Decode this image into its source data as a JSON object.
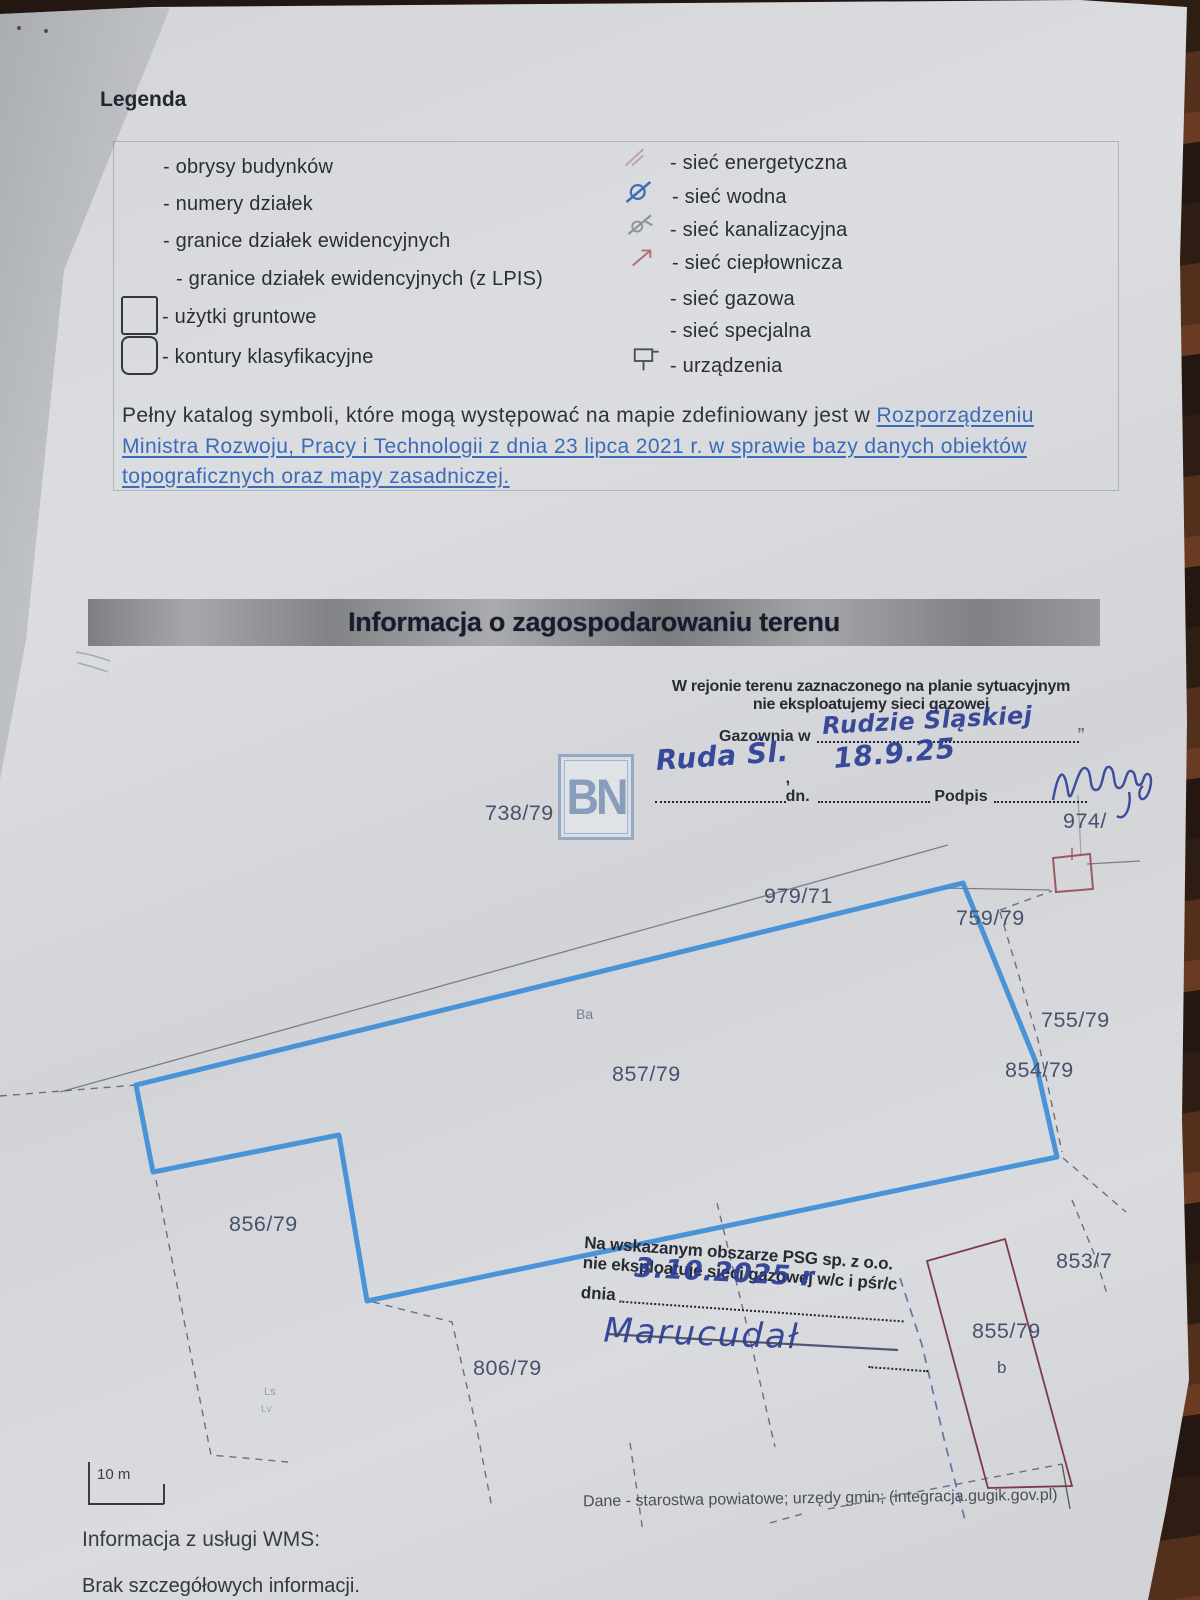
{
  "legend": {
    "title": "Legenda",
    "left_items": [
      "- obrysy budynków",
      "- numery działek",
      "- granice działek ewidencyjnych",
      "- granice działek ewidencyjnych (z LPIS)",
      "- użytki gruntowe",
      "- kontury klasyfikacyjne"
    ],
    "right_items": [
      "- sieć energetyczna",
      "- sieć wodna",
      "- sieć kanalizacyjna",
      "- sieć ciepłownicza",
      "- sieć gazowa",
      "- sieć specjalna",
      "- urządzenia"
    ],
    "catalog_note": {
      "plain": "Pełny katalog symboli, które mogą występować na mapie zdefiniowany jest w ",
      "link_line1": "Rozporządzeniu",
      "link_line2": "Ministra Rozwoju, Pracy i Technologii z dnia 23 lipca 2021 r. w sprawie bazy danych obiektów",
      "link_line3": "topograficznych oraz mapy zasadniczej."
    }
  },
  "section_title": "Informacja o zagospodarowaniu terenu",
  "gazownia_stamp": {
    "line1": "W rejonie terenu zaznaczonego na planie sytuacyjnym",
    "line2": "nie eksploatujemy sieci gazowej",
    "gazownia_label": "Gazownia w",
    "city_handwritten": "Rudzie Śląskiej",
    "place_handwritten": "Ruda Śl.",
    "dn_label": ", dn.",
    "date_handwritten": "18.9.25",
    "podpis_label": "Podpis"
  },
  "psg_stamp": {
    "line1": "Na wskazanym obszarze PSG sp. z o.o.",
    "line2": "nie eksploatuje sieci gazowej w/c i pśr/c",
    "dnia_label": "dnia",
    "date_handwritten": "3.10.2025 r",
    "signature_handwritten": "Marucudał"
  },
  "map": {
    "watermark": "BN",
    "parcel_labels": [
      {
        "text": "738/79"
      },
      {
        "text": "974/"
      },
      {
        "text": "979/71"
      },
      {
        "text": "759/79"
      },
      {
        "text": "755/79"
      },
      {
        "text": "854/79"
      },
      {
        "text": "857/79"
      },
      {
        "text": "856/79"
      },
      {
        "text": "853/7"
      },
      {
        "text": "855/79"
      },
      {
        "text": "806/79"
      }
    ],
    "land_use_label": "Ba",
    "building_letter": "b",
    "faint_code_1": "Ls",
    "faint_code_2": "Lv"
  },
  "scale_label": "10 m",
  "footer": {
    "source_line": "Dane - starostwa powiatowe; urzędy gmin; (integracja.gugik.gov.pl)",
    "wms_label": "Informacja z usługi WMS:",
    "wms_value": "Brak szczegółowych informacji."
  },
  "colors": {
    "highlight_boundary": "#3d8ed6",
    "link_blue": "#3a6cb8",
    "ink_blue": "#2c3d94",
    "building_outline_maroon": "#7d3b4a",
    "building_outline_red": "#94424c",
    "parcel_label": "#47536e"
  }
}
